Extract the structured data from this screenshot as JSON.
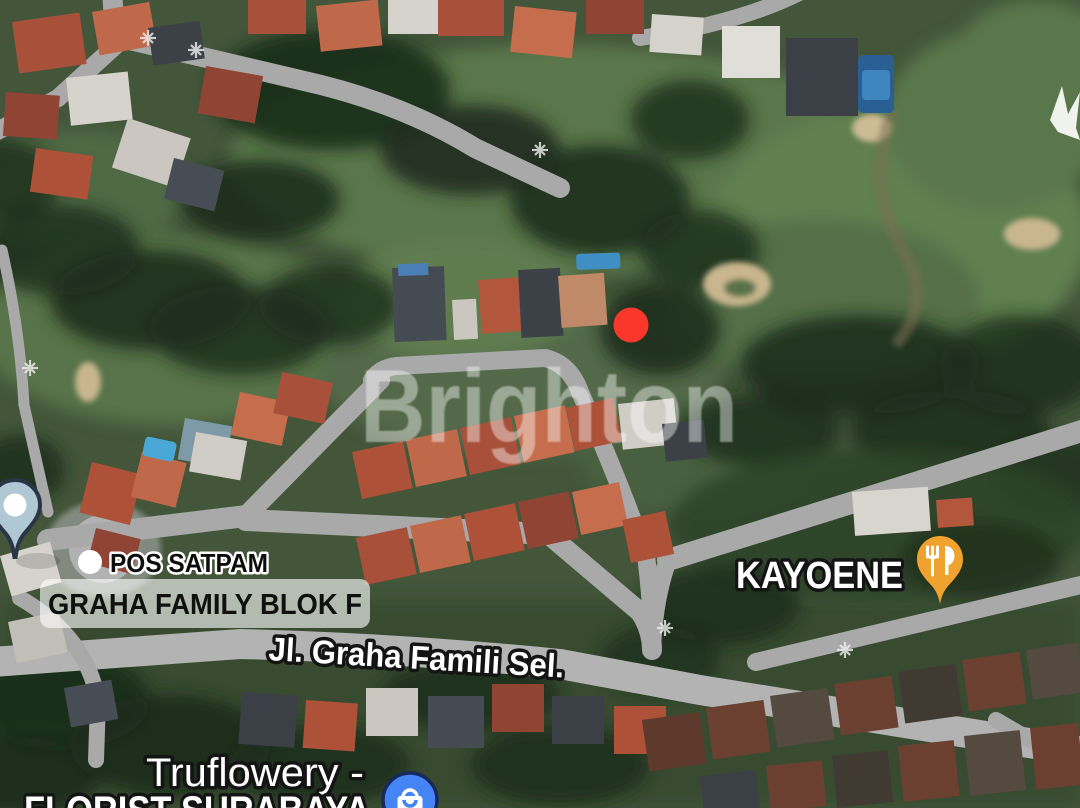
{
  "map": {
    "watermark": "Brighton",
    "markers": {
      "red_dot": {
        "color": "#FB372C"
      },
      "pos_satpam": {
        "label": "POS SATPAM"
      },
      "graha_annotation": {
        "label": "GRAHA FAMILY BLOK F"
      },
      "road_label": {
        "label": "Jl. Graha Famili Sel."
      },
      "kayoene": {
        "label": "KAYOENE",
        "pin_color": "#EFA22D"
      },
      "truflowery": {
        "label_line1": "Truflowery -",
        "label_line2": "FLORIST SURABAYA",
        "pin_color": "#4584F4",
        "pin_ring": "#16295A"
      },
      "generic_pin": {
        "color": "#B0C7D4"
      }
    }
  }
}
